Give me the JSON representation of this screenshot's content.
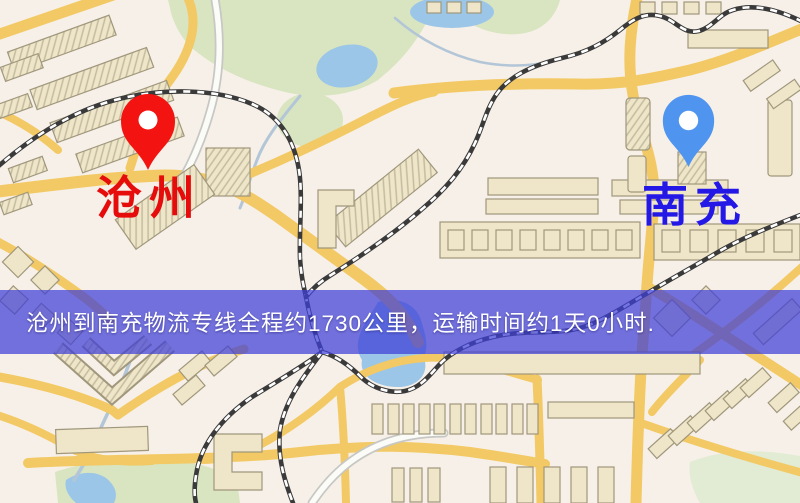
{
  "banner": {
    "text": "沧州到南充物流专线全程约1730公里，运输时间约1天0小时.",
    "background_color": "rgba(62,62,215,0.72)",
    "text_color": "#ffffff"
  },
  "markers": {
    "origin": {
      "label": "沧州",
      "label_color": "#e60c0c",
      "pin_color": "#f31412",
      "pin_hole_color": "#ffffff"
    },
    "destination": {
      "label": "南充",
      "label_color": "#2318e6",
      "pin_color": "#4f95ef",
      "pin_hole_color": "#ffffff"
    }
  },
  "map_palette": {
    "background": "#f7f0e8",
    "road": "#f2c964",
    "white_road": "#fbfbf8",
    "white_road_casing": "#c7c7c4",
    "building_fill": "#efe6c9",
    "building_stroke": "#a0977c",
    "park": "#d8e5c0",
    "park_light": "#e2ebd3",
    "water": "#9cc6e8",
    "stream": "#b2c6d8",
    "railway": "#3a3a3a",
    "railway_dash": "#ffffff"
  }
}
